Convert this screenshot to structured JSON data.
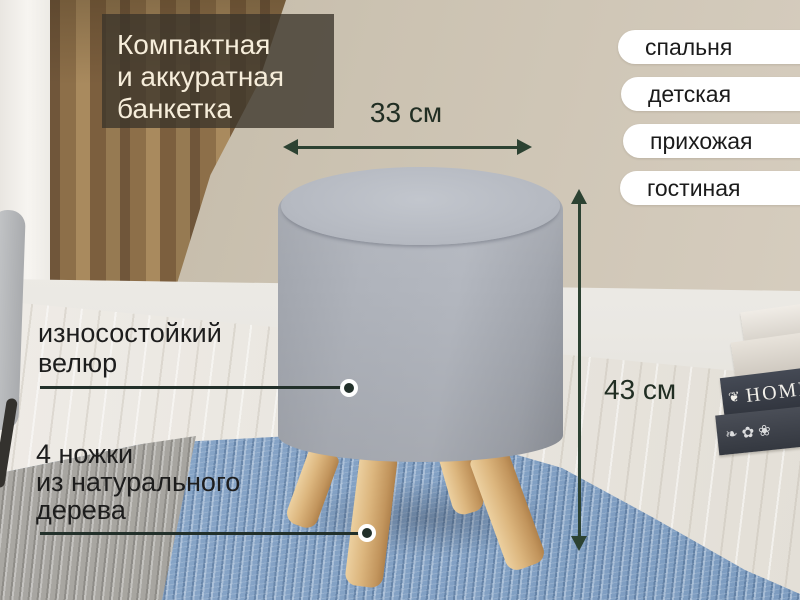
{
  "title": {
    "lines": [
      "Компактная",
      "и аккуратная",
      "банкетка"
    ]
  },
  "tags": [
    {
      "label": "спальня"
    },
    {
      "label": "детская"
    },
    {
      "label": "прихожая"
    },
    {
      "label": "гостиная"
    }
  ],
  "dimensions": {
    "width_label": "33 см",
    "height_label": "43 см"
  },
  "callouts": {
    "velour": {
      "lines": [
        "износостойкий",
        "велюр"
      ]
    },
    "legs": {
      "lines": [
        "4 ножки",
        "из натурального",
        "дерева"
      ]
    }
  },
  "scene": {
    "book_title": "HOME",
    "book_ornament": "❦",
    "floral_pattern": "❧✿❀"
  },
  "colors": {
    "accent_green": "#2c4232",
    "title_overlay_bg": "rgba(59,53,42,0.78)",
    "title_text": "#f6edda",
    "tag_bg": "#ffffff",
    "tag_text": "#1b1b1b",
    "annotation_text": "#1d1d1d",
    "ottoman_gray": "#aeb2ba",
    "leg_wood": "#dcb67e",
    "rug_blue": "#84a3c6",
    "rug_gray": "#a7a5a0",
    "wall_beige": "#cdc4b3"
  }
}
